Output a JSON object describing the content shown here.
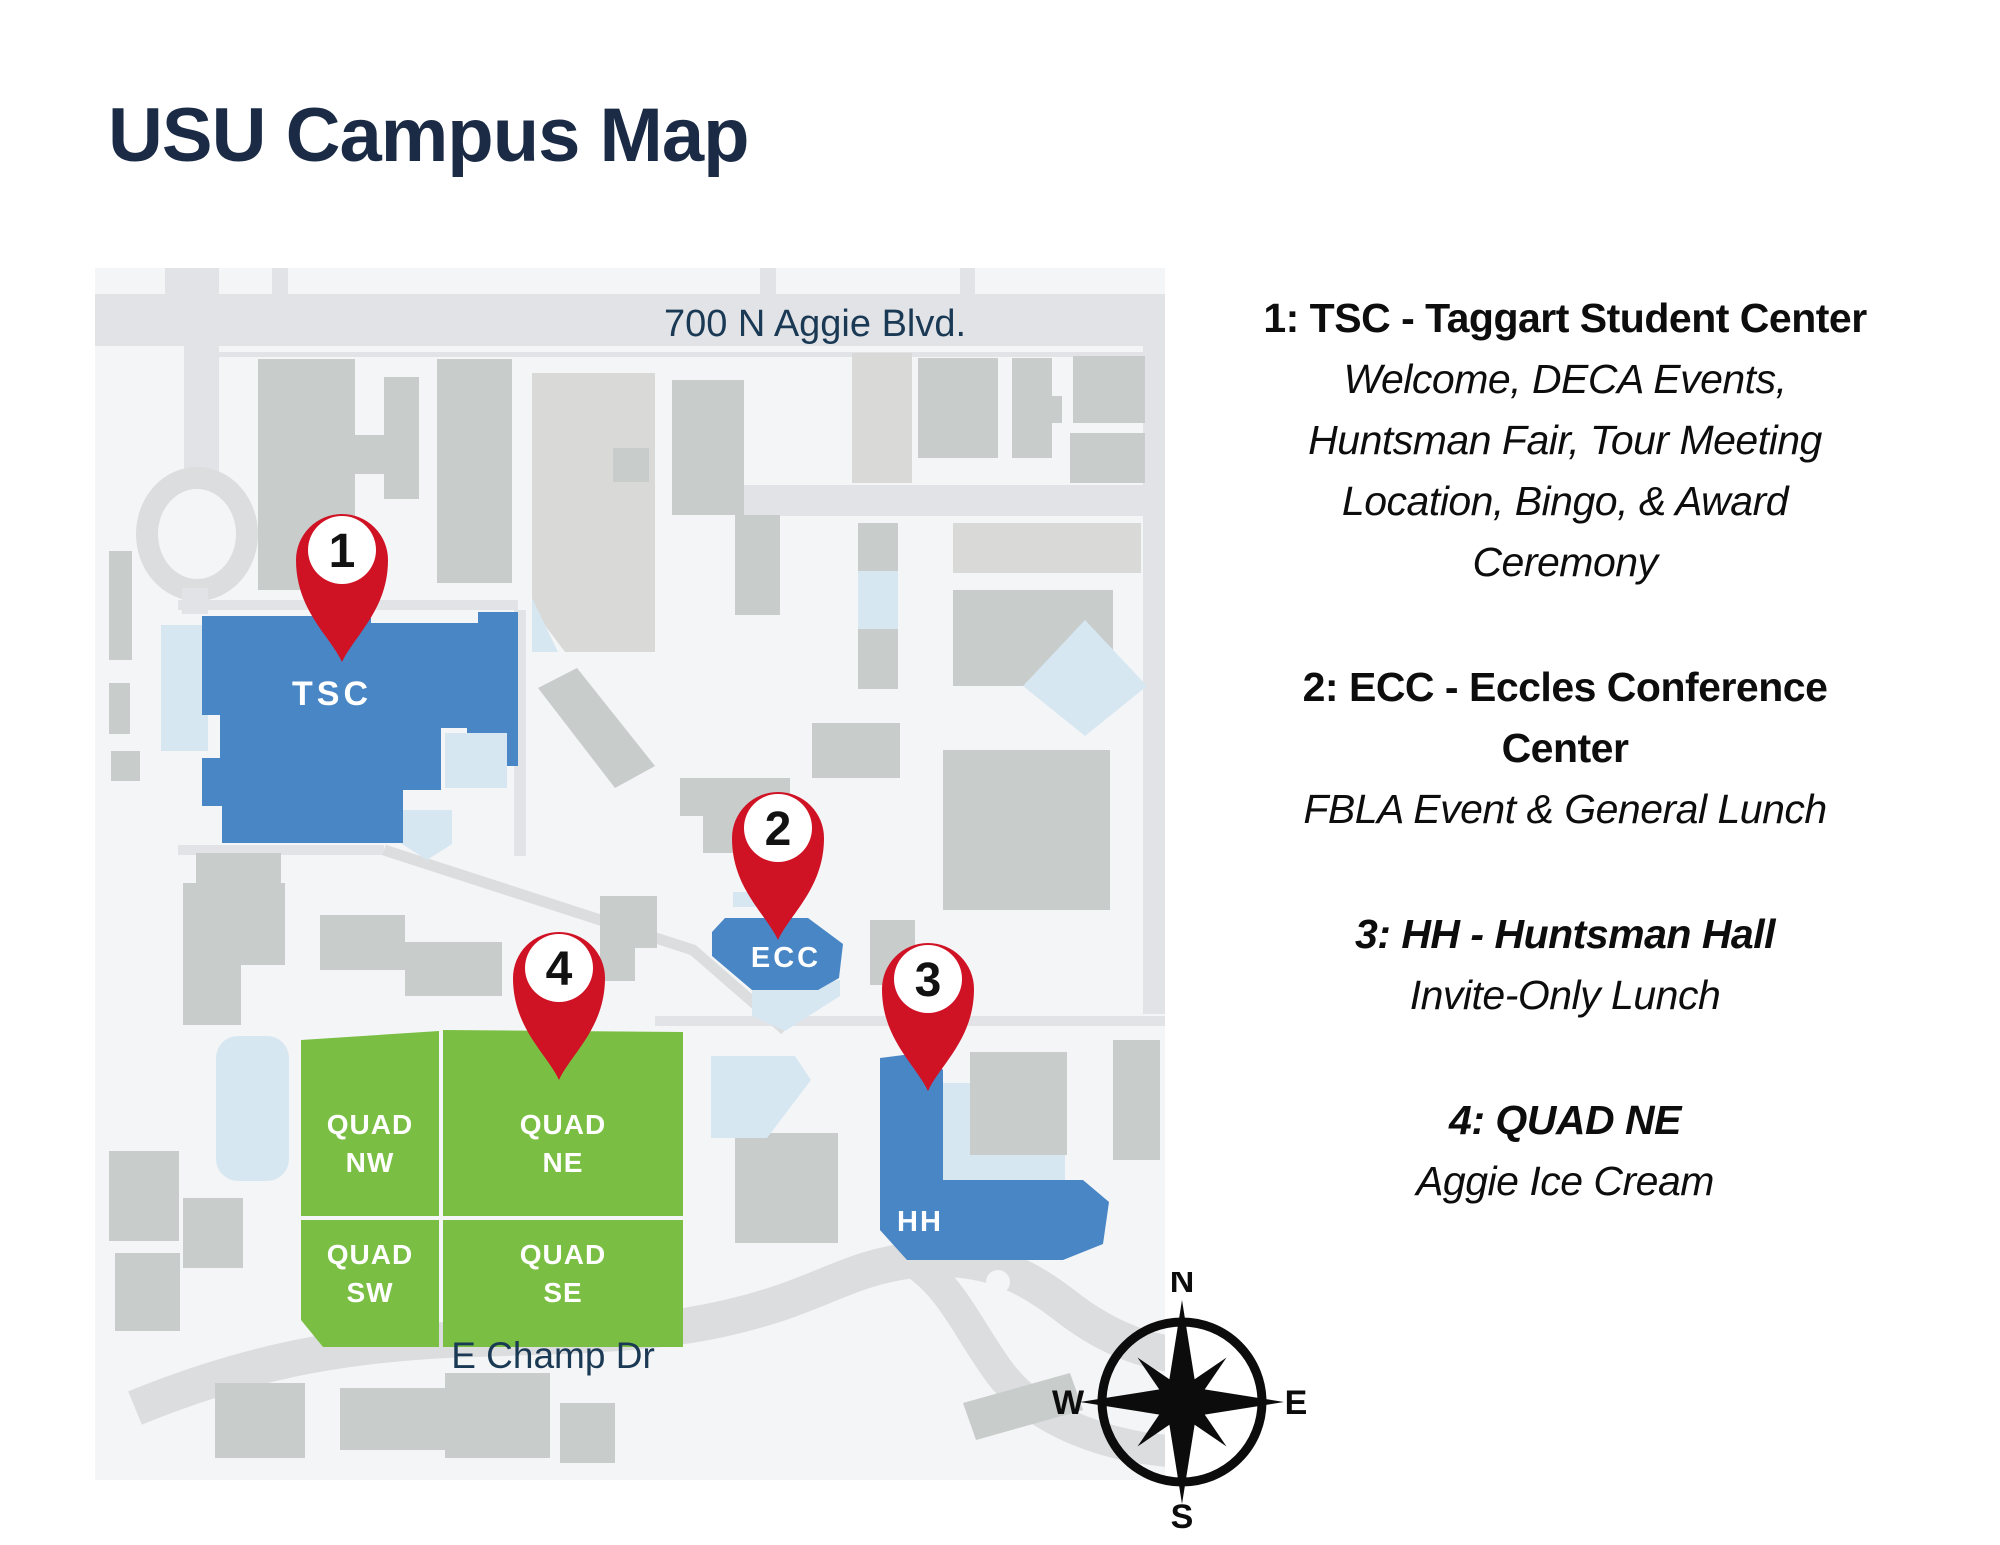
{
  "page": {
    "title": "USU Campus Map"
  },
  "map": {
    "street_labels": {
      "aggie": "700 N  Aggie Blvd.",
      "champ": "E Champ Dr"
    },
    "buildings": {
      "tsc": "TSC",
      "ecc": "ECC",
      "hh": "HH",
      "quads": [
        {
          "line1": "QUAD",
          "line2": "NW"
        },
        {
          "line1": "QUAD",
          "line2": "NE"
        },
        {
          "line1": "QUAD",
          "line2": "SW"
        },
        {
          "line1": "QUAD",
          "line2": "SE"
        }
      ]
    },
    "pins": [
      "1",
      "2",
      "3",
      "4"
    ],
    "compass": {
      "north": "N",
      "east": "E",
      "south": "S",
      "west": "W"
    }
  },
  "legend": {
    "entries": [
      {
        "header_lines": [
          "1: TSC - Taggart Student Center"
        ],
        "detail_lines": [
          "Welcome, DECA Events,",
          "Huntsman Fair, Tour Meeting",
          "Location, Bingo, & Award",
          "Ceremony"
        ]
      },
      {
        "header_lines": [
          "2: ECC - Eccles Conference",
          "Center"
        ],
        "detail_lines": [
          "FBLA Event & General Lunch"
        ]
      },
      {
        "header_lines": [
          "3: HH - Huntsman Hall"
        ],
        "detail_lines": [
          "Invite-Only Lunch"
        ]
      },
      {
        "header_lines": [
          "4: QUAD NE"
        ],
        "detail_lines": [
          "Aggie Ice Cream"
        ]
      }
    ]
  },
  "colors": {
    "title_navy": "#1b2b45",
    "street_navy": "#1a3954",
    "pin_red": "#d01225",
    "building_blue": "#4886c5",
    "quad_green": "#7abf43",
    "light_blue": "#d7e7f2",
    "road_gray": "#e2e3e6",
    "road_dark": "#dcdddf",
    "building_gray": "#c8cccb",
    "building_light_gray": "#d9dad8",
    "map_bg": "#f4f5f6",
    "legend_text": "#0d0d0d"
  }
}
